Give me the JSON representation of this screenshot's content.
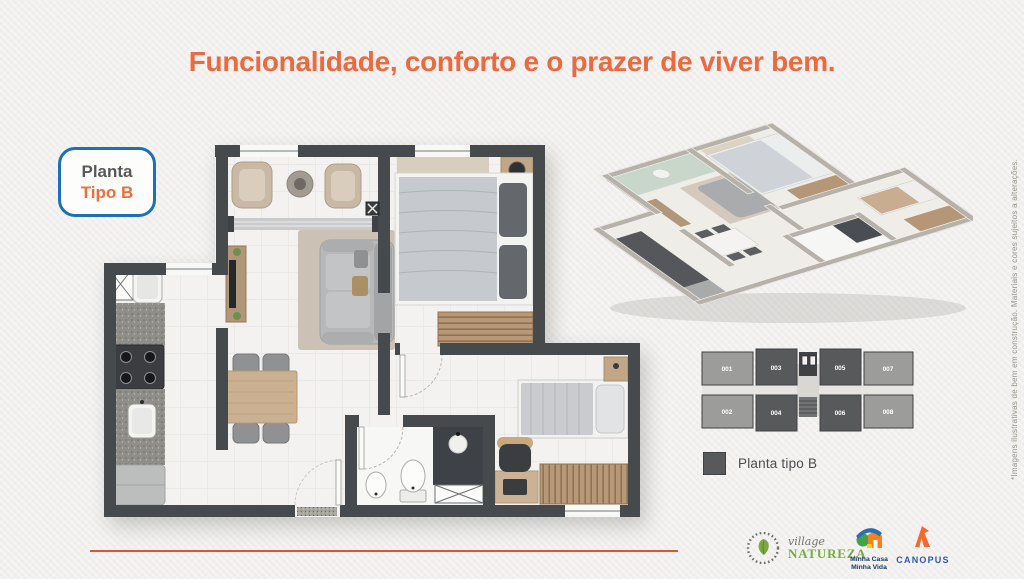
{
  "page": {
    "title": "Funcionalidade, conforto e o prazer de viver bem.",
    "background": "#f1f0ee"
  },
  "badge": {
    "line1": "Planta",
    "line2": "Tipo B"
  },
  "colors": {
    "accent_orange": "#ec6a3f",
    "badge_blue": "#1b70b8",
    "text_gray": "#58595b",
    "wall_gray": "#474a4d",
    "wood": "#c9af90",
    "keyplan_dark": "#58595b",
    "keyplan_light": "#9c9c9a",
    "divider_orange": "#e8512d",
    "natureza_green": "#7ca93f",
    "mcmv_navy": "#173a63",
    "canopus_blue": "#2f59a7",
    "canopus_orange": "#f26a2e"
  },
  "key_plan": {
    "units": [
      {
        "id": "001",
        "tipo_b": false
      },
      {
        "id": "002",
        "tipo_b": false
      },
      {
        "id": "003",
        "tipo_b": true
      },
      {
        "id": "004",
        "tipo_b": true
      },
      {
        "id": "005",
        "tipo_b": true
      },
      {
        "id": "006",
        "tipo_b": true
      },
      {
        "id": "007",
        "tipo_b": false
      },
      {
        "id": "008",
        "tipo_b": false
      }
    ],
    "legend_label": "Planta tipo B"
  },
  "disclaimer": "*Imagens ilustrativas de bem em construção. Materiais e cores sujeitos a alterações.",
  "footer": {
    "village": {
      "line1": "village",
      "line2": "NATUREZA"
    },
    "mcmv": {
      "line1": "Minha Casa",
      "line2": "Minha Vida"
    },
    "canopus": {
      "label": "CANOPUS"
    }
  }
}
